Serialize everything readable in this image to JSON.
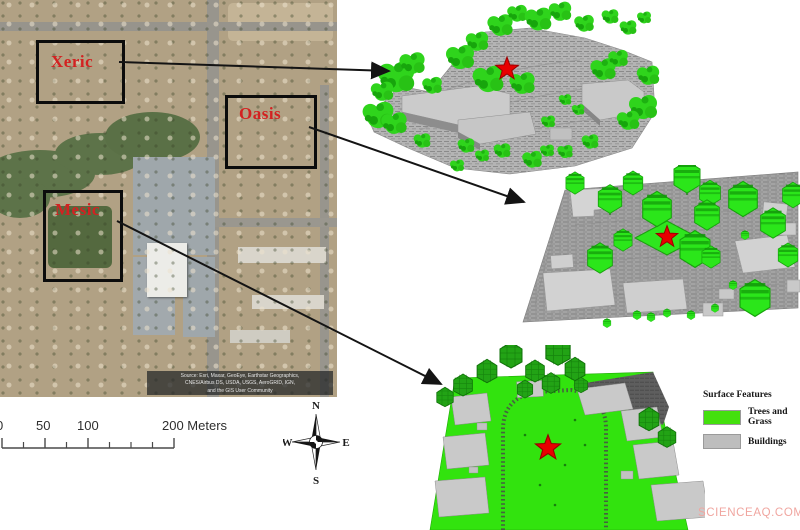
{
  "map": {
    "region_labels": {
      "xeric": "Xeric",
      "oasis": "Oasis",
      "mesic": "Mesic"
    },
    "attribution": {
      "line1": "Source: Esri, Maxar, GeoEye, Earthstar Geographics,",
      "line2": "CNES/Airbus DS, USDA, USGS, AeroGRID, IGN,",
      "line3": "and the GIS User Community"
    }
  },
  "scale_bar": {
    "label_0": "0",
    "label_50": "50",
    "label_100": "100",
    "label_200": "200 Meters"
  },
  "compass": {
    "north": "N",
    "south": "S",
    "east": "E",
    "west": "W"
  },
  "legend": {
    "title": "Surface Features",
    "items": [
      {
        "label": "Trees and Grass",
        "color": "#44e00e"
      },
      {
        "label": "Buildings",
        "color": "#bdbdbd"
      }
    ]
  },
  "models": [
    {
      "region": "Xeric",
      "marker": "red-star"
    },
    {
      "region": "Oasis",
      "marker": "red-star"
    },
    {
      "region": "Mesic",
      "marker": "red-star"
    }
  ],
  "watermark": "SCIENCEAQ.COM",
  "colors": {
    "region_label_red": "#d32121",
    "star_red": "#e80000",
    "trees_and_grass_green": "#44e00e",
    "building_gray": "#bdbdbd",
    "box_border_black": "#0c0c0c"
  }
}
